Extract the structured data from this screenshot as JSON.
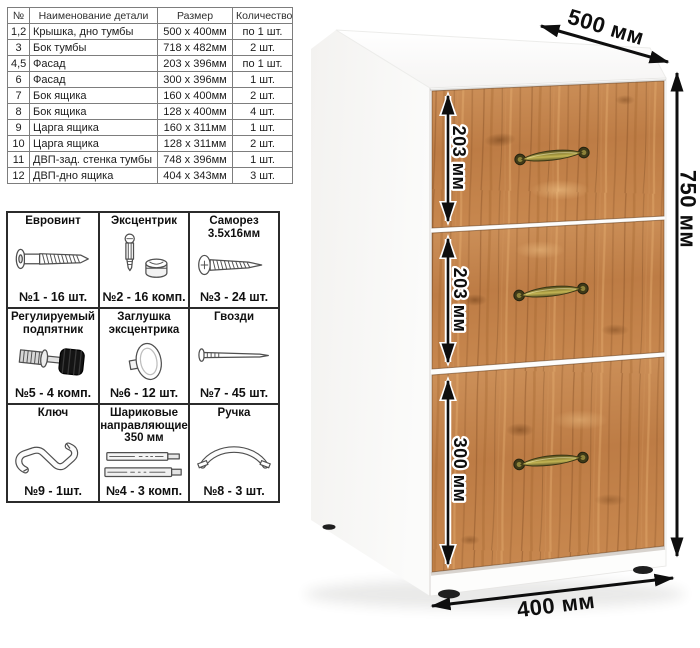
{
  "parts_table": {
    "headers": [
      "№",
      "Наименование детали",
      "Размер",
      "Количество"
    ],
    "rows": [
      [
        "1,2",
        "Крышка, дно тумбы",
        "500 x 400мм",
        "по 1 шт."
      ],
      [
        "3",
        "Бок тумбы",
        "718 x 482мм",
        "2 шт."
      ],
      [
        "4,5",
        "Фасад",
        "203 x 396мм",
        "по 1 шт."
      ],
      [
        "6",
        "Фасад",
        "300 x 396мм",
        "1 шт."
      ],
      [
        "7",
        "Бок ящика",
        "160 x 400мм",
        "2 шт."
      ],
      [
        "8",
        "Бок ящика",
        "128 x 400мм",
        "4 шт."
      ],
      [
        "9",
        "Царга ящика",
        "160 x 311мм",
        "1 шт."
      ],
      [
        "10",
        "Царга ящика",
        "128 x 311мм",
        "2 шт."
      ],
      [
        "11",
        "ДВП-зад. стенка тумбы",
        "748 x 396мм",
        "1 шт."
      ],
      [
        "12",
        "ДВП-дно ящика",
        "404 x 343мм",
        "3 шт."
      ]
    ]
  },
  "hardware": {
    "items": [
      {
        "title": "Евровинт",
        "count": "№1 - 16 шт.",
        "icon": "euro-screw-icon"
      },
      {
        "title": "Эксцентрик",
        "count": "№2 - 16 комп.",
        "icon": "cam-lock-icon"
      },
      {
        "title": "Саморез 3.5х16мм",
        "count": "№3 - 24 шт.",
        "icon": "self-tapping-screw-icon"
      },
      {
        "title": "Регулируемый подпятник",
        "count": "№5 - 4 комп.",
        "icon": "adjustable-foot-icon"
      },
      {
        "title": "Заглушка эксцентрика",
        "count": "№6 - 12 шт.",
        "icon": "cam-cover-icon"
      },
      {
        "title": "Гвозди",
        "count": "№7 - 45 шт.",
        "icon": "nails-icon"
      },
      {
        "title": "Ключ",
        "count": "№9 - 1шт.",
        "icon": "hex-key-icon"
      },
      {
        "title": "Шариковые направляющие 350 мм",
        "count": "№4 - 3 комп.",
        "icon": "ball-bearing-slides-icon"
      },
      {
        "title": "Ручка",
        "count": "№8 - 3 шт.",
        "icon": "drawer-handle-icon"
      }
    ]
  },
  "cabinet": {
    "dimensions": {
      "depth": "500 мм",
      "height": "750 мм",
      "width": "400 мм",
      "drawer1": "203 мм",
      "drawer2": "203 мм",
      "drawer3": "300 мм"
    },
    "colors": {
      "wood": "#c2834e",
      "handle_brass": "#8a7f33",
      "arrow": "#0e0e0e",
      "body_white": "#fbfbfa"
    }
  }
}
